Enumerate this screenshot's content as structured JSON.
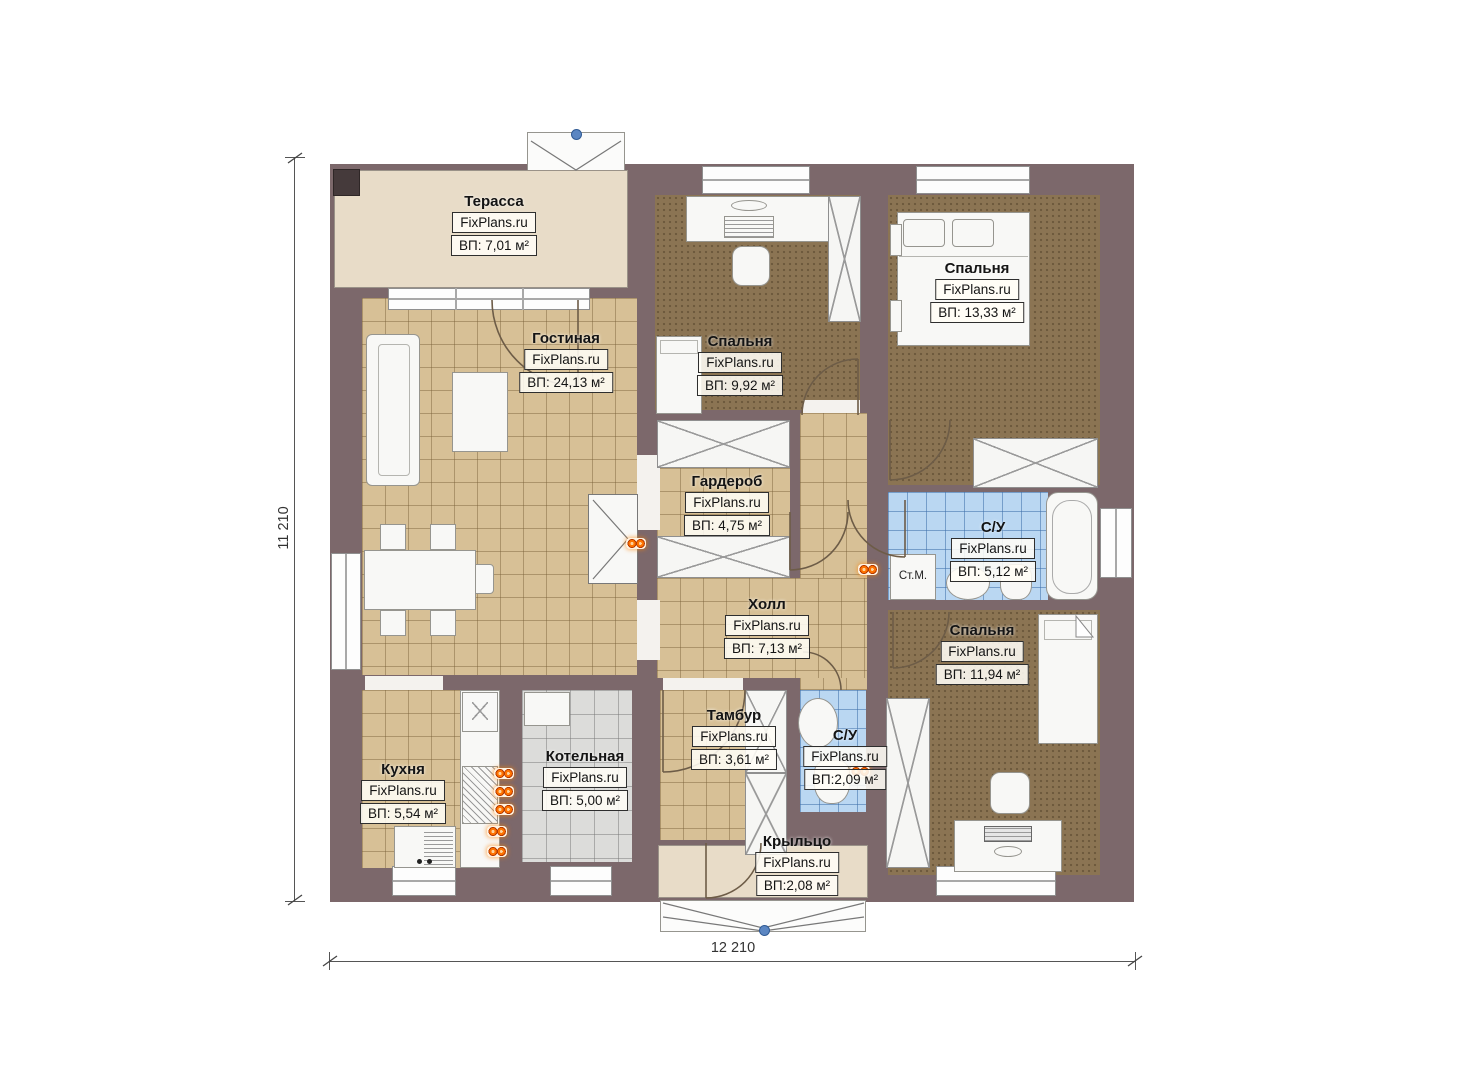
{
  "plan": {
    "dimensions": {
      "horizontal": "12 210",
      "vertical": "11 210"
    },
    "annotations": {
      "washing_machine": "Ст.М."
    },
    "rooms": [
      {
        "id": "terrace",
        "name": "Терасса",
        "brand": "FixPlans.ru",
        "area": "ВП: 7,01 м²"
      },
      {
        "id": "living",
        "name": "Гостиная",
        "brand": "FixPlans.ru",
        "area": "ВП: 24,13 м²"
      },
      {
        "id": "bedroom1",
        "name": "Спальня",
        "brand": "FixPlans.ru",
        "area": "ВП: 9,92 м²"
      },
      {
        "id": "bedroom2",
        "name": "Спальня",
        "brand": "FixPlans.ru",
        "area": "ВП: 13,33 м²"
      },
      {
        "id": "garderob",
        "name": "Гардероб",
        "brand": "FixPlans.ru",
        "area": "ВП: 4,75 м²"
      },
      {
        "id": "bath1",
        "name": "С/У",
        "brand": "FixPlans.ru",
        "area": "ВП: 5,12 м²"
      },
      {
        "id": "hall",
        "name": "Холл",
        "brand": "FixPlans.ru",
        "area": "ВП: 7,13 м²"
      },
      {
        "id": "bedroom3",
        "name": "Спальня",
        "brand": "FixPlans.ru",
        "area": "ВП: 11,94 м²"
      },
      {
        "id": "kitchen",
        "name": "Кухня",
        "brand": "FixPlans.ru",
        "area": "ВП: 5,54 м²"
      },
      {
        "id": "boiler",
        "name": "Котельная",
        "brand": "FixPlans.ru",
        "area": "ВП: 5,00 м²"
      },
      {
        "id": "tambour",
        "name": "Тамбур",
        "brand": "FixPlans.ru",
        "area": "ВП: 3,61 м²"
      },
      {
        "id": "bath2",
        "name": "С/У",
        "brand": "FixPlans.ru",
        "area": "ВП:2,09 м²"
      },
      {
        "id": "porch",
        "name": "Крыльцо",
        "brand": "FixPlans.ru",
        "area": "ВП:2,08 м²"
      }
    ],
    "colors": {
      "wall": "#7c686b",
      "floor_tile_tan": "#d7c096",
      "floor_bedroom": "#8b7453",
      "floor_bath": "#bad7f2",
      "floor_boiler": "#dcdcda",
      "terrace": "#e8dcc8",
      "outlet_orange": "#ff7300",
      "marker_blue": "#5b86c2"
    }
  }
}
